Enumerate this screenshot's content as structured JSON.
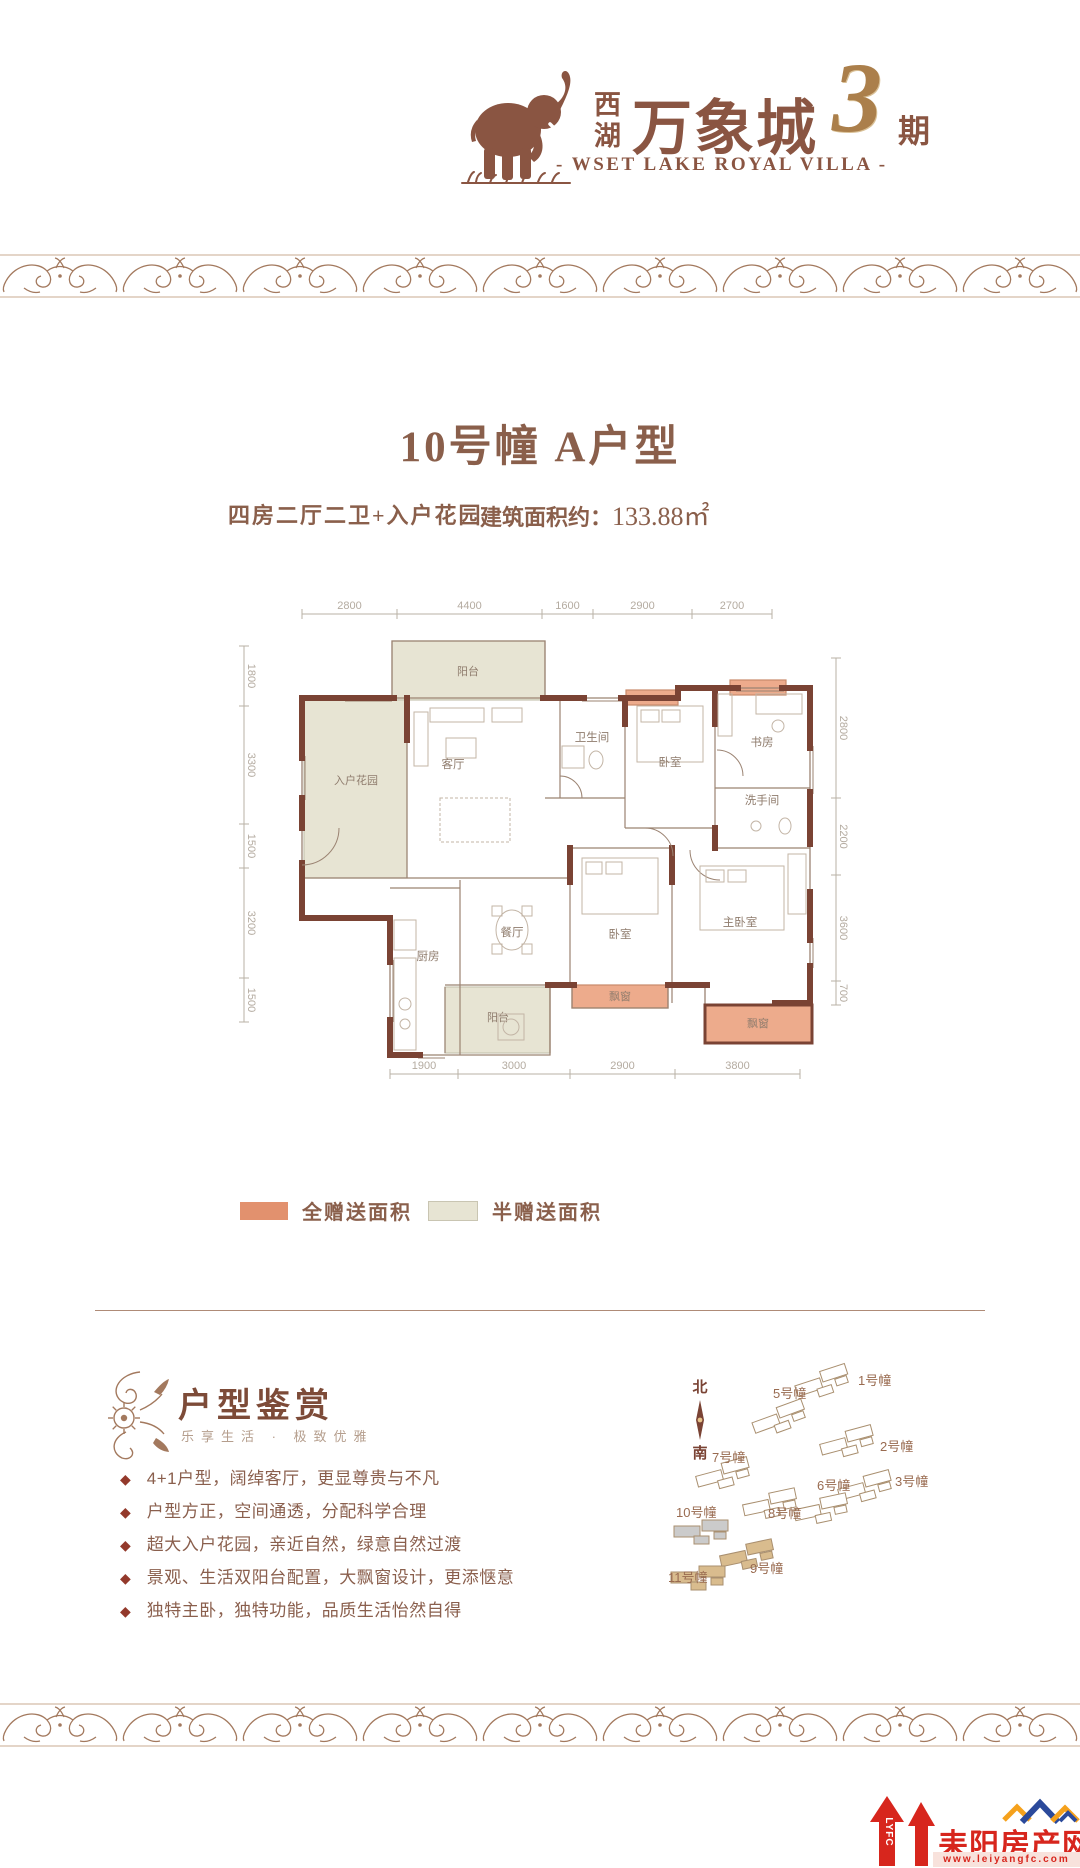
{
  "colors": {
    "accent": "#8a5542",
    "full_gift": "#e2916e",
    "full_gift_zone": "#edab8c",
    "half_gift": "#e7e4d3",
    "half_gift_border": "#c9c5b2",
    "wall": "#7a4334",
    "thin_wall": "#9b8372",
    "dim_text": "#b4aba0",
    "room_text": "#8f7c6d",
    "flourish": "#a3795e",
    "footer_red": "#d7261d",
    "roof_blue": "#2b4a9b",
    "roof_orange": "#f5a11c"
  },
  "brand": {
    "logo_icon": "elephant-icon",
    "cn_top": "西",
    "cn_bottom": "湖",
    "cn_big": "万象城",
    "phase_num": "3",
    "phase_suffix": "期",
    "en_line": "- WSET LAKE ROYAL VILLA -"
  },
  "unit": {
    "title": "10号幢  A户型",
    "layout_desc": "四房二厅二卫+入户花园",
    "area_label": "建筑面积约：",
    "area_value": "133.88㎡"
  },
  "floorplan": {
    "dims": {
      "top": {
        "labels": [
          "2800",
          "4400",
          "1600",
          "2900",
          "2700"
        ],
        "ticks": [
          102,
          197,
          342,
          393,
          492,
          572
        ],
        "y": 116
      },
      "left": {
        "labels": [
          "1800",
          "3300",
          "1500",
          "3200",
          "1500"
        ],
        "ticks": [
          148,
          208,
          326,
          370,
          480,
          524
        ],
        "x": 44
      },
      "right": {
        "labels": [
          "2800",
          "2200",
          "3600",
          "700"
        ],
        "ticks": [
          160,
          300,
          377,
          483,
          507
        ],
        "x": 636
      },
      "bottom": {
        "labels": [
          "1900",
          "3000",
          "2900",
          "3800"
        ],
        "ticks": [
          190,
          258,
          370,
          475,
          600
        ],
        "y": 576
      }
    },
    "zones": [
      {
        "type": "half",
        "x": 192,
        "y": 143,
        "w": 153,
        "h": 59,
        "label": "阳台",
        "lx": 268,
        "ly": 177
      },
      {
        "type": "half",
        "x": 104,
        "y": 202,
        "w": 103,
        "h": 178,
        "label": "入户花园",
        "lx": 156,
        "ly": 286
      },
      {
        "type": "half",
        "x": 245,
        "y": 489,
        "w": 105,
        "h": 66,
        "label": "阳台",
        "lx": 298,
        "ly": 523
      },
      {
        "type": "full",
        "x": 372,
        "y": 487,
        "w": 96,
        "h": 23,
        "label": "飘窗",
        "lx": 420,
        "ly": 502
      },
      {
        "type": "full",
        "x": 505,
        "y": 507,
        "w": 107,
        "h": 38,
        "label": "飘窗",
        "lx": 558,
        "ly": 529
      },
      {
        "type": "full",
        "x": 426,
        "y": 192,
        "w": 52,
        "h": 15,
        "label": "",
        "lx": 0,
        "ly": 0
      },
      {
        "type": "full",
        "x": 530,
        "y": 182,
        "w": 56,
        "h": 15,
        "label": "",
        "lx": 0,
        "ly": 0
      }
    ],
    "rooms": [
      {
        "label": "客厅",
        "x": 253,
        "y": 270
      },
      {
        "label": "卫生间",
        "x": 392,
        "y": 243
      },
      {
        "label": "卧室",
        "x": 470,
        "y": 268
      },
      {
        "label": "书房",
        "x": 562,
        "y": 248
      },
      {
        "label": "洗手间",
        "x": 562,
        "y": 306
      },
      {
        "label": "厨房",
        "x": 228,
        "y": 462
      },
      {
        "label": "餐厅",
        "x": 312,
        "y": 438
      },
      {
        "label": "卧室",
        "x": 420,
        "y": 440
      },
      {
        "label": "主卧室",
        "x": 540,
        "y": 428
      }
    ]
  },
  "legend": {
    "full": "全赠送面积",
    "half": "半赠送面积"
  },
  "features": {
    "title": "户型鉴赏",
    "subtitle": "乐享生活 · 极致优雅",
    "bullet_char": "◆",
    "items": [
      "4+1户型，阔绰客厅，更显尊贵与不凡",
      "户型方正，空间通透，分配科学合理",
      "超大入户花园，亲近自然，绿意自然过渡",
      "景观、生活双阳台配置，大飘窗设计，更添惬意",
      "独特主卧，独特功能，品质生活怡然自得"
    ]
  },
  "sitemap": {
    "north": "北",
    "south": "南",
    "buildings": [
      {
        "name": "1号幢",
        "lx": 318,
        "ly": 49,
        "fx": 283,
        "fy": 46,
        "rot": -18,
        "style": "plain"
      },
      {
        "name": "5号幢",
        "lx": 233,
        "ly": 62,
        "fx": 240,
        "fy": 82,
        "rot": -20,
        "style": "plain"
      },
      {
        "name": "2号幢",
        "lx": 340,
        "ly": 115,
        "fx": 308,
        "fy": 106,
        "rot": -15,
        "style": "plain"
      },
      {
        "name": "7号幢",
        "lx": 172,
        "ly": 126,
        "fx": 184,
        "fy": 138,
        "rot": -15,
        "style": "plain"
      },
      {
        "name": "3号幢",
        "lx": 355,
        "ly": 150,
        "fx": 326,
        "fy": 151,
        "rot": -15,
        "style": "plain"
      },
      {
        "name": "6号幢",
        "lx": 277,
        "ly": 154,
        "fx": 282,
        "fy": 173,
        "rot": -12,
        "style": "plain"
      },
      {
        "name": "8号幢",
        "lx": 228,
        "ly": 182,
        "fx": 231,
        "fy": 168,
        "rot": -12,
        "style": "plain"
      },
      {
        "name": "10号幢",
        "lx": 136,
        "ly": 181,
        "fx": 162,
        "fy": 195,
        "rot": 0,
        "style": "gray"
      },
      {
        "name": "9号幢",
        "lx": 210,
        "ly": 237,
        "fx": 208,
        "fy": 219,
        "rot": -12,
        "style": "tan"
      },
      {
        "name": "11号幢",
        "lx": 128,
        "ly": 246,
        "fx": 159,
        "fy": 241,
        "rot": 0,
        "style": "tan"
      }
    ]
  },
  "footer": {
    "abbr": "LYFC",
    "name": "耒阳房产网",
    "url": "www.leiyangfc.com"
  }
}
